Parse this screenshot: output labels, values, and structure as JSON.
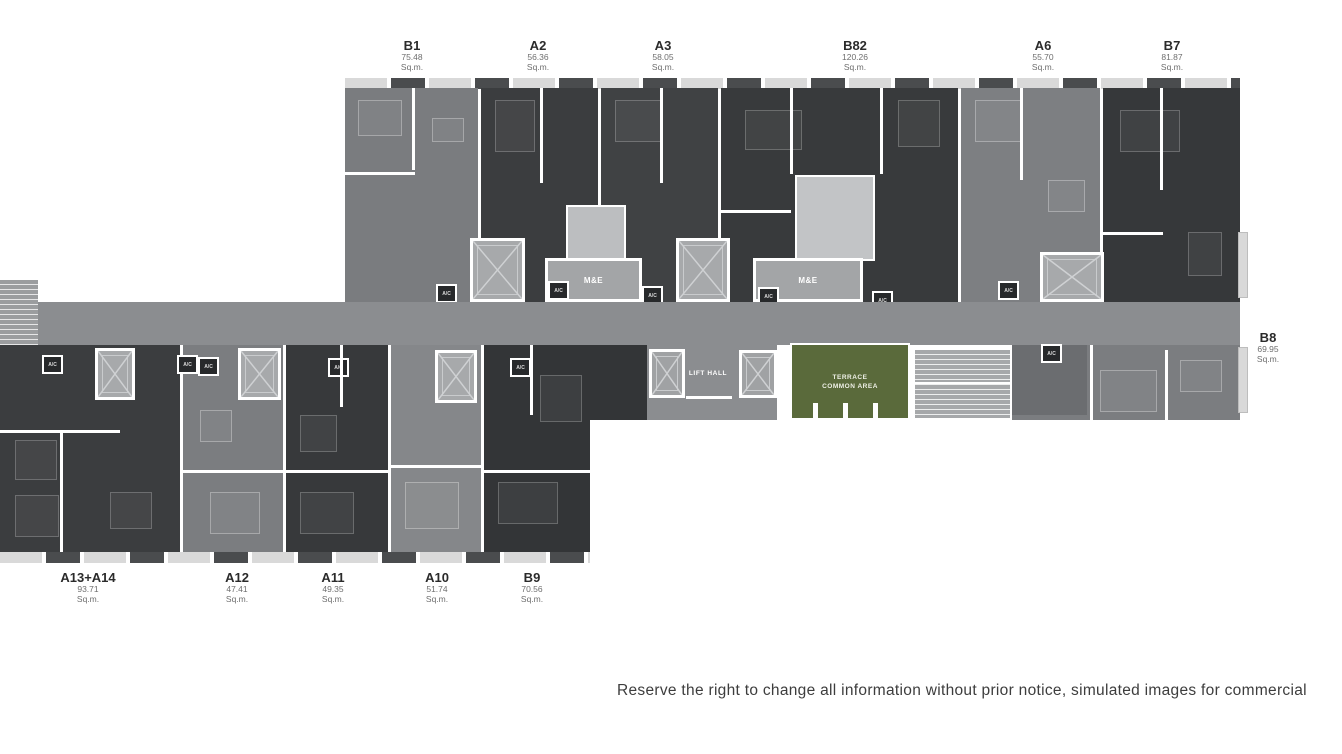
{
  "plan": {
    "units_top": [
      {
        "id": "B1",
        "area": "75.48",
        "unit": "Sq.m."
      },
      {
        "id": "A2",
        "area": "56.36",
        "unit": "Sq.m."
      },
      {
        "id": "A3",
        "area": "58.05",
        "unit": "Sq.m."
      },
      {
        "id": "B82",
        "area": "120.26",
        "unit": "Sq.m."
      },
      {
        "id": "A6",
        "area": "55.70",
        "unit": "Sq.m."
      },
      {
        "id": "B7",
        "area": "81.87",
        "unit": "Sq.m."
      }
    ],
    "unit_right": {
      "id": "B8",
      "area": "69.95",
      "unit": "Sq.m."
    },
    "units_bottom": [
      {
        "id": "A13+A14",
        "area": "93.71",
        "unit": "Sq.m."
      },
      {
        "id": "A12",
        "area": "47.41",
        "unit": "Sq.m."
      },
      {
        "id": "A11",
        "area": "49.35",
        "unit": "Sq.m."
      },
      {
        "id": "A10",
        "area": "51.74",
        "unit": "Sq.m."
      },
      {
        "id": "B9",
        "area": "70.56",
        "unit": "Sq.m."
      }
    ],
    "rooms": {
      "me": "M&E",
      "ac": "A/C",
      "lift_hall": "LIFT HALL",
      "terrace_line1": "TERRACE",
      "terrace_line2": "COMMON AREA"
    },
    "colors": {
      "dark_unit": "#3b3d3f",
      "medium_unit": "#7b7d80",
      "corridor": "#8b8d90",
      "lift_shaft": "#a7a9ab",
      "me_room": "#a3a5a7",
      "ac_box": "#27292b",
      "terrace_green": "#5a6a3b",
      "wall": "#ffffff"
    }
  },
  "footer": {
    "disclaimer": "Reserve the right to change all information without prior notice, simulated images for commercial"
  }
}
